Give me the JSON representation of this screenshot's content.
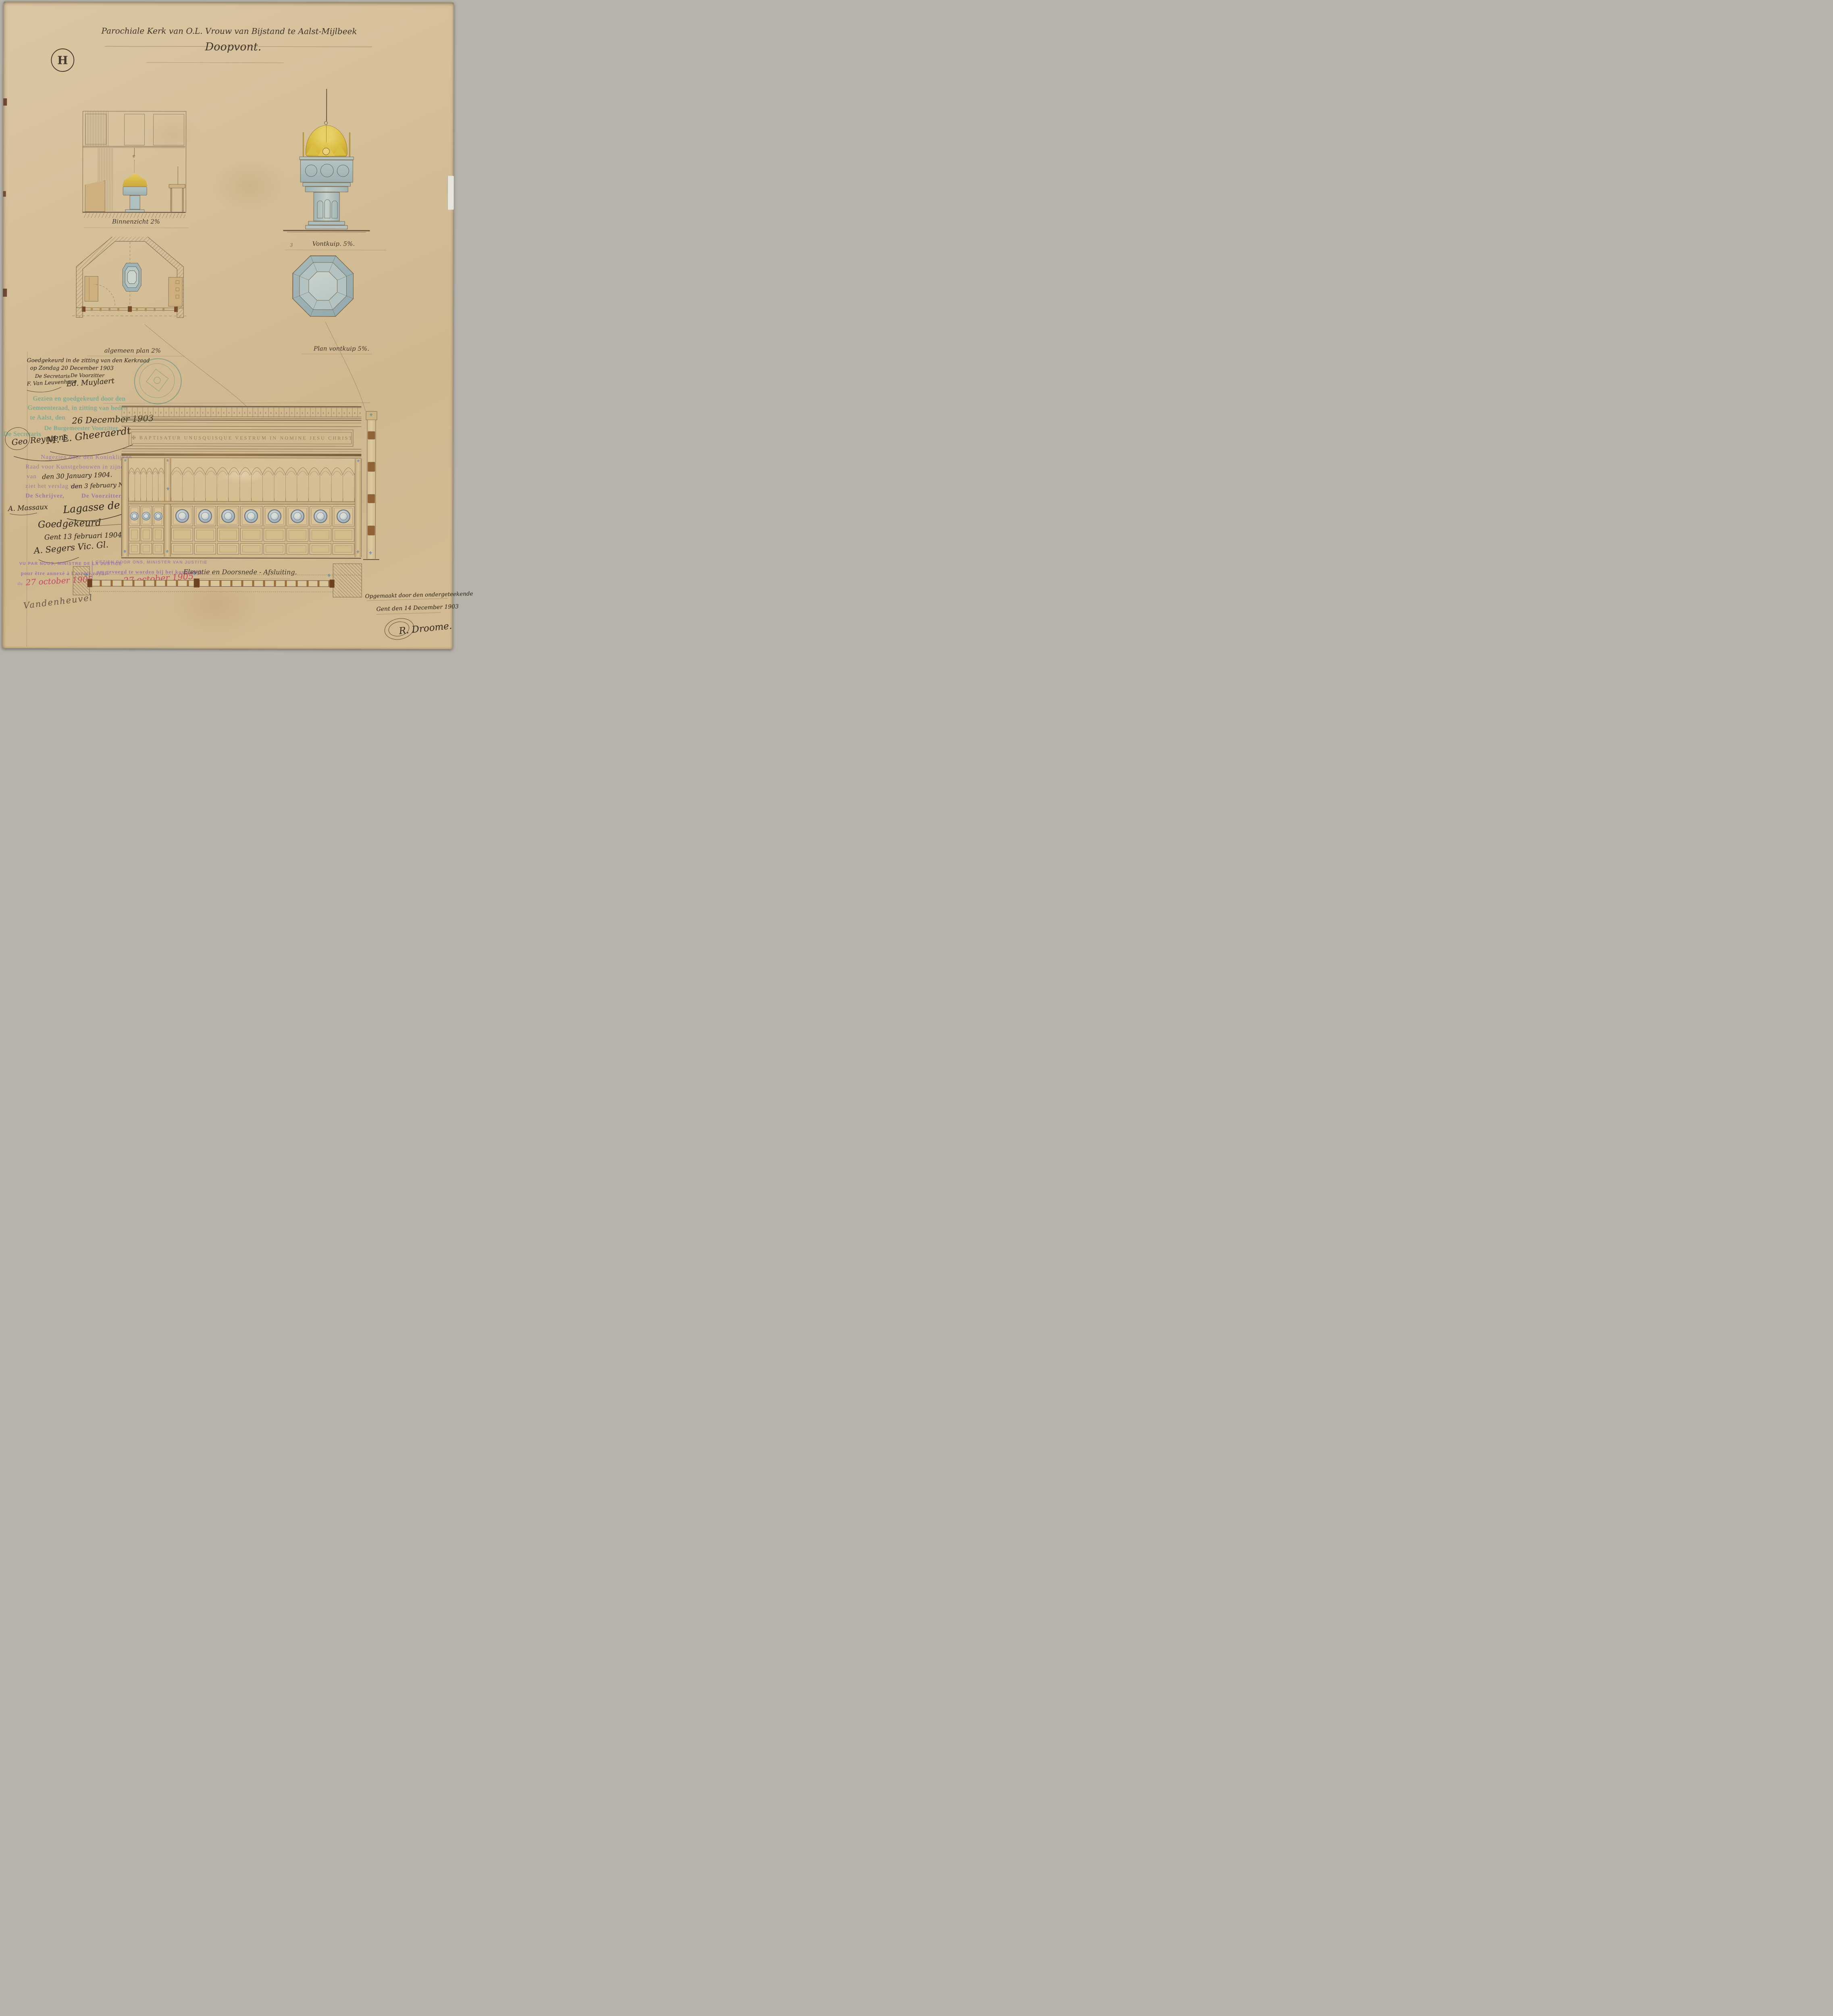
{
  "plate": {
    "sheet_mark": "H",
    "title": "Parochiale Kerk van O.L. Vrouw van Bijstand te Aalst-Mijlbeek",
    "subtitle": "Doopvont."
  },
  "labels": {
    "binnenzicht": "Binnenzicht 2%",
    "vontkuip": "Vontkuip. 5%.",
    "vontkuip_index": "3",
    "algemeen_plan": "algemeen plan 2%",
    "plan_vontkuip": "Plan vontkuip 5%.",
    "afsluiting": "Elevatie en Doorsnede - Afsluiting.",
    "frieze_inscription": "✠ BAPTISATUR UNUSQUISQUE VESTRUM IN NOMINE JESU CHRISTI ✠"
  },
  "approvals": {
    "kerkraad": {
      "line1": "Goedgekeurd in de zitting van den Kerkraad",
      "line2": "op Zondag 20 December 1903",
      "secretary_label": "De Secretaris",
      "secretary_signature": "F. Van Leuvenhage",
      "chairman_label": "De Voorzitter",
      "chairman_signature": "Ed. Muylaert"
    },
    "gemeenteraad": {
      "line1": "Gezien en goedgekeurd door den",
      "line2": "Gemeenteraad, in zitting van heden",
      "line3": "te Aalst, den",
      "date_handwritten": "26 December 1903",
      "mayor_label": "De Burgemeester Voorzitter",
      "secretary_label": "De Secretaris",
      "secretary_signature": "Geo Reyntens",
      "mayor_signature": "M. L. Gheeraerdt"
    },
    "koninklijke_raad": {
      "line1": "Nagezien door den Koninklijken",
      "line2": "Raad voor Kunstgebouwen in zijne zitting",
      "line3_prefix": "van",
      "line3_handwritten": "den 30 January 1904.",
      "line4_prefix": "ziet het verslag van",
      "line4_handwritten": "den 3 february N° 8506.",
      "clerk_label": "De Schrijver,",
      "chairman_label": "De Voorzitter,",
      "clerk_signature": "A. Massaux",
      "chairman_signature": "Lagasse de Locht"
    },
    "bisdom": {
      "line1": "Goedgekeurd",
      "line2": "Gent 13 februari 1904",
      "signature": "A. Segers Vic. Gl."
    },
    "ministerie": {
      "fr_line1": "VU PAR NOUS, MINISTRE DE LA JUSTICE",
      "fr_line2": "pour être annexé à l'arrêté royal",
      "fr_line3": "du",
      "fr_date_handwritten": "27 october 1905.",
      "nl_line1": "GEZIEN DOOR ONS, MINISTER VAN JUSTITIE",
      "nl_line2": "om gevoegd te worden bij het koninklijk",
      "nl_line3": "besluit van",
      "nl_date_handwritten": "27 october 1905",
      "minister_signature": "Vandenheuvel"
    },
    "colophon": {
      "line1": "Opgemaakt door den ondergeteekende",
      "line2": "Gent den 14 December 1903",
      "signature": "R. Droome."
    }
  },
  "icons": {
    "fleur": "⚜"
  },
  "colors": {
    "paper": "#d4be98",
    "ink": "#3f352a",
    "stamp_green": "#68a492",
    "stamp_purple": "#9868ac",
    "handwriting_red": "#c64f6b",
    "watercolor_blue": "#a3b8ba",
    "watercolor_gold": "#dcbf49",
    "wood_tan": "#cdb080",
    "seal_teal": "#4f8c7d"
  }
}
